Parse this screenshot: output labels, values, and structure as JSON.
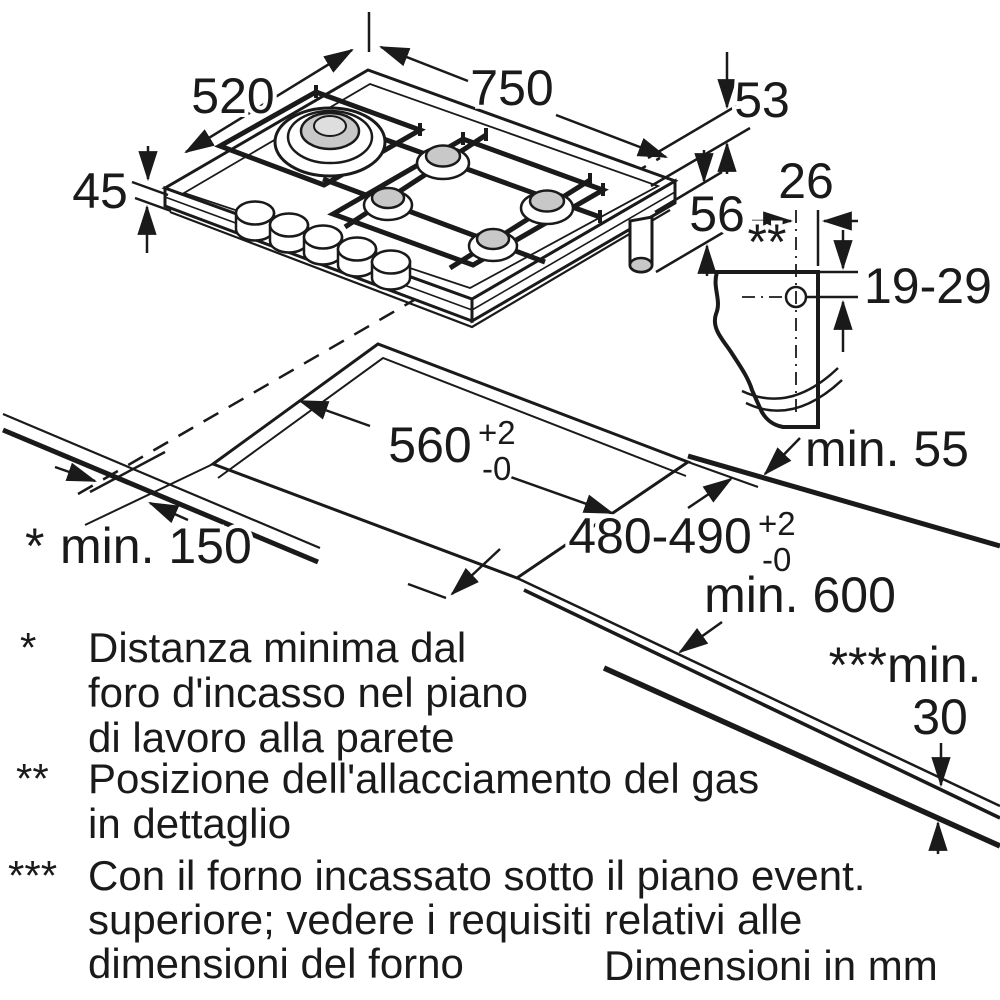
{
  "dimensions": {
    "hob_width": "750",
    "hob_depth": "520",
    "hob_height_front": "45",
    "hob_height_right": "53",
    "hob_height_gas": "56",
    "gas_conn_offset": "26",
    "gas_conn_marker": "**",
    "gas_conn_height_range": "19-29",
    "cutout_width": "560",
    "cutout_width_tol_plus": "+2",
    "cutout_width_tol_minus": "-0",
    "cutout_depth": "480-490",
    "cutout_depth_tol_plus": "+2",
    "cutout_depth_tol_minus": "-0",
    "wall_marker": "*",
    "wall_clearance": "min. 150",
    "side_clearance": "min. 55",
    "worktop_depth": "min. 600",
    "oven_gap_label": "***min.",
    "oven_gap_value": "30"
  },
  "footnotes": [
    {
      "marker": "*",
      "lines": [
        "Distanza minima dal",
        "foro d'incasso nel piano",
        "di lavoro alla parete"
      ]
    },
    {
      "marker": "**",
      "lines": [
        "Posizione dell'allacciamento del gas",
        "in dettaglio"
      ]
    },
    {
      "marker": "***",
      "lines": [
        "Con il forno incassato sotto il piano event.",
        "superiore; vedere i requisiti relativi alle",
        "dimensioni del forno"
      ]
    }
  ],
  "units_note": "Dimensioni in mm"
}
